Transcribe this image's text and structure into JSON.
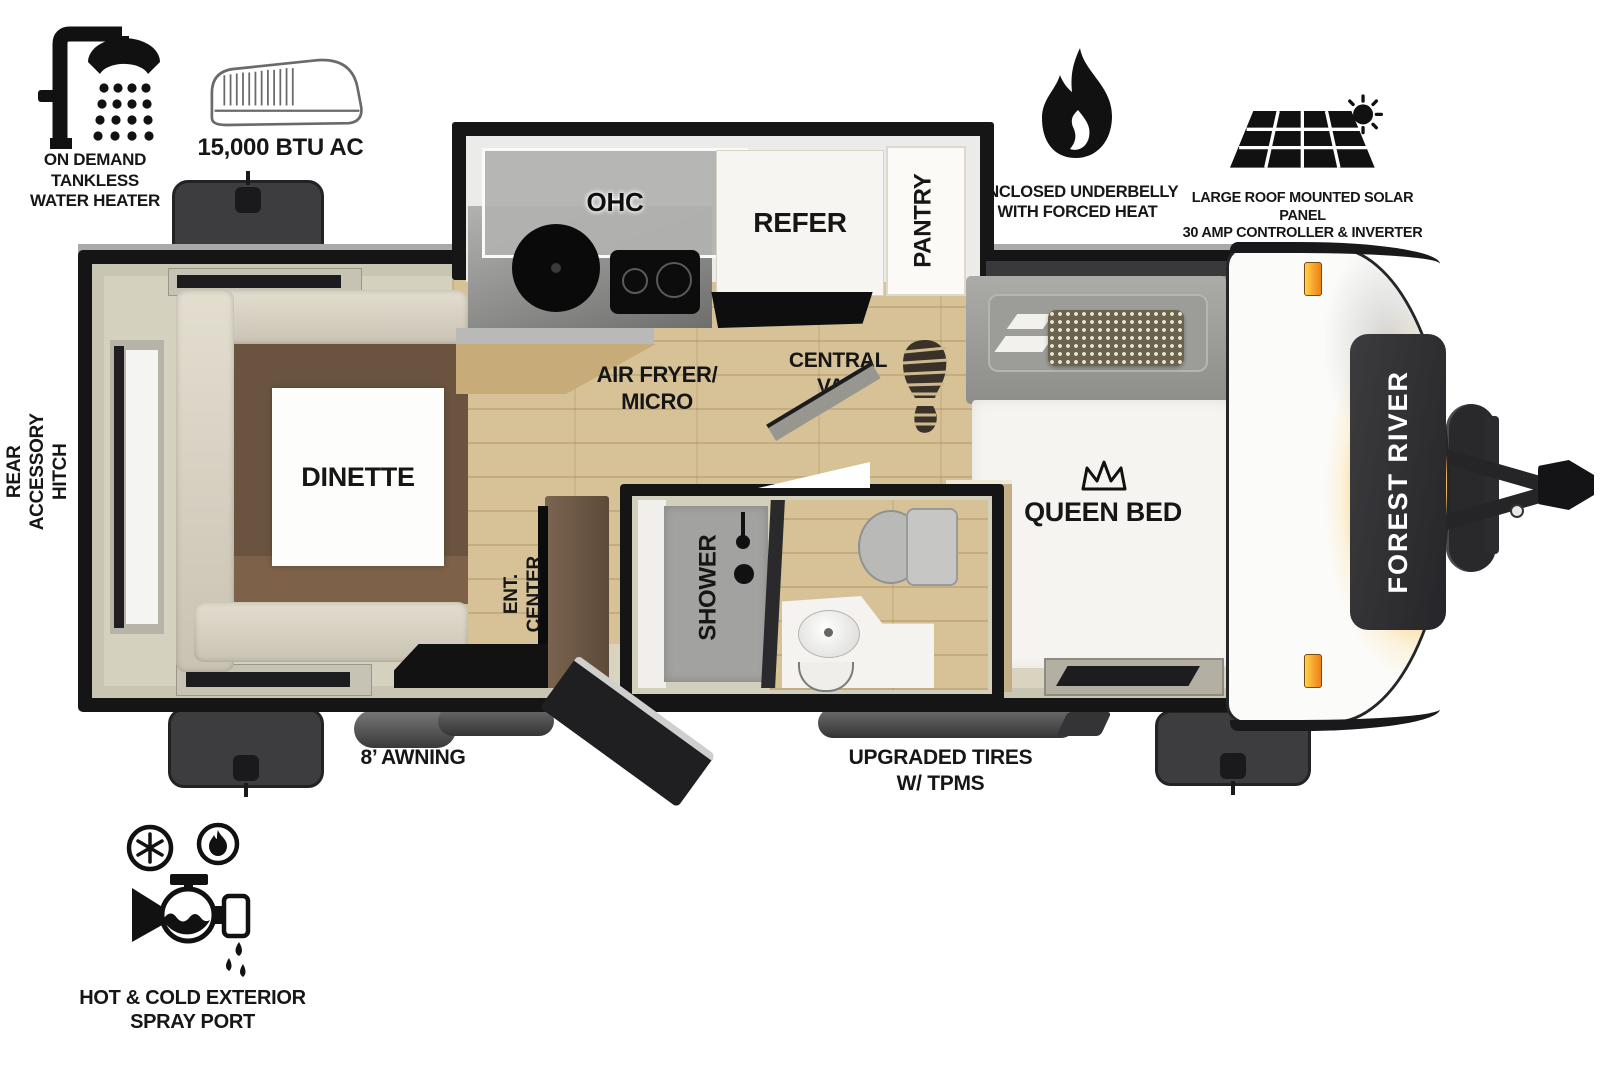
{
  "title": "Forest River travel trailer floor plan",
  "brand": {
    "name": "FOREST RIVER"
  },
  "features": {
    "water_heater": {
      "lines": [
        "ON DEMAND",
        "TANKLESS",
        "WATER HEATER"
      ]
    },
    "ac": {
      "label": "15,000 BTU AC"
    },
    "underbelly": {
      "lines": [
        "ENCLOSED UNDERBELLY",
        "WITH FORCED HEAT"
      ]
    },
    "solar": {
      "lines": [
        "LARGE ROOF MOUNTED SOLAR PANEL",
        "30 AMP CONTROLLER & INVERTER PREP"
      ]
    },
    "rear_hitch": {
      "lines": [
        "REAR",
        "ACCESSORY",
        "HITCH"
      ]
    },
    "spray_port": {
      "lines": [
        "HOT & COLD EXTERIOR",
        "SPRAY PORT"
      ]
    },
    "awning": {
      "label": "8’ AWNING"
    },
    "tires": {
      "lines": [
        "UPGRADED TIRES",
        "W/ TPMS"
      ]
    }
  },
  "rooms": {
    "ohc": "OHC",
    "refer": "REFER",
    "pantry": "PANTRY",
    "dinette": "DINETTE",
    "air_fryer_micro": {
      "lines": [
        "AIR FRYER/",
        "MICRO"
      ]
    },
    "central_vac": {
      "lines": [
        "CENTRAL",
        "VAC"
      ]
    },
    "ent_center": {
      "lines": [
        "ENT.",
        "CENTER"
      ]
    },
    "shower": "SHOWER",
    "queen_bed": "QUEEN BED"
  },
  "colors": {
    "wall_black": "#151515",
    "wall_beige": "#c9c5b3",
    "floor_wood": "#d6c296",
    "sofa_cream": "#d9d4c5",
    "table_brown": "#6a5440",
    "accent_orange": "#f5ae35",
    "marker_orange": "#f07f16",
    "badge_dark": "#3c3c3e",
    "icon_black": "#111111"
  }
}
